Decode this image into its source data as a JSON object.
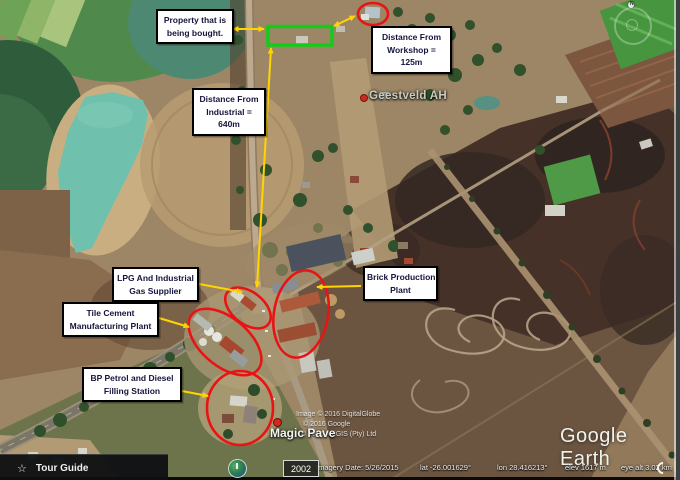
{
  "callouts": {
    "property": {
      "lines": [
        "Property that is",
        "being bought."
      ]
    },
    "workshop": {
      "lines": [
        "Distance From",
        "Workshop =",
        "125m"
      ]
    },
    "industrial": {
      "lines": [
        "Distance From",
        "Industrial =",
        "640m"
      ]
    },
    "lpg": {
      "lines": [
        "LPG And Industrial",
        "Gas Supplier"
      ]
    },
    "tile": {
      "lines": [
        "Tile Cement",
        "Manufacturing Plant"
      ]
    },
    "brick": {
      "lines": [
        "Brick Production",
        "Plant"
      ]
    },
    "bp": {
      "lines": [
        "BP Petrol and Diesel",
        "Filling Station"
      ]
    }
  },
  "map_labels": {
    "settlement": "Geestveld AH",
    "business": "Magic Pave"
  },
  "watermark": {
    "imagery": "Image © 2016 DigitalGlobe",
    "google": "© 2016 Google",
    "afrigis": "© 2016 AfriGIS (Pty) Ltd"
  },
  "logo": {
    "text": "Google Earth"
  },
  "status_bar": {
    "imagery_date": "Imagery Date: 5/26/2015",
    "lat": "lat  -26.001629°",
    "lon": "lon  28.416213°",
    "elev": "elev  1617 m",
    "eye_alt": "eye alt  3.02 km"
  },
  "controls": {
    "tour_guide": "Tour Guide",
    "star": "☆",
    "year_badge": "2002",
    "compass_north": "N"
  },
  "colors": {
    "annotation_red": "#e81414",
    "annotation_yellow": "#ffd400",
    "property_green": "#0ece17",
    "callout_text": "#14143c"
  }
}
